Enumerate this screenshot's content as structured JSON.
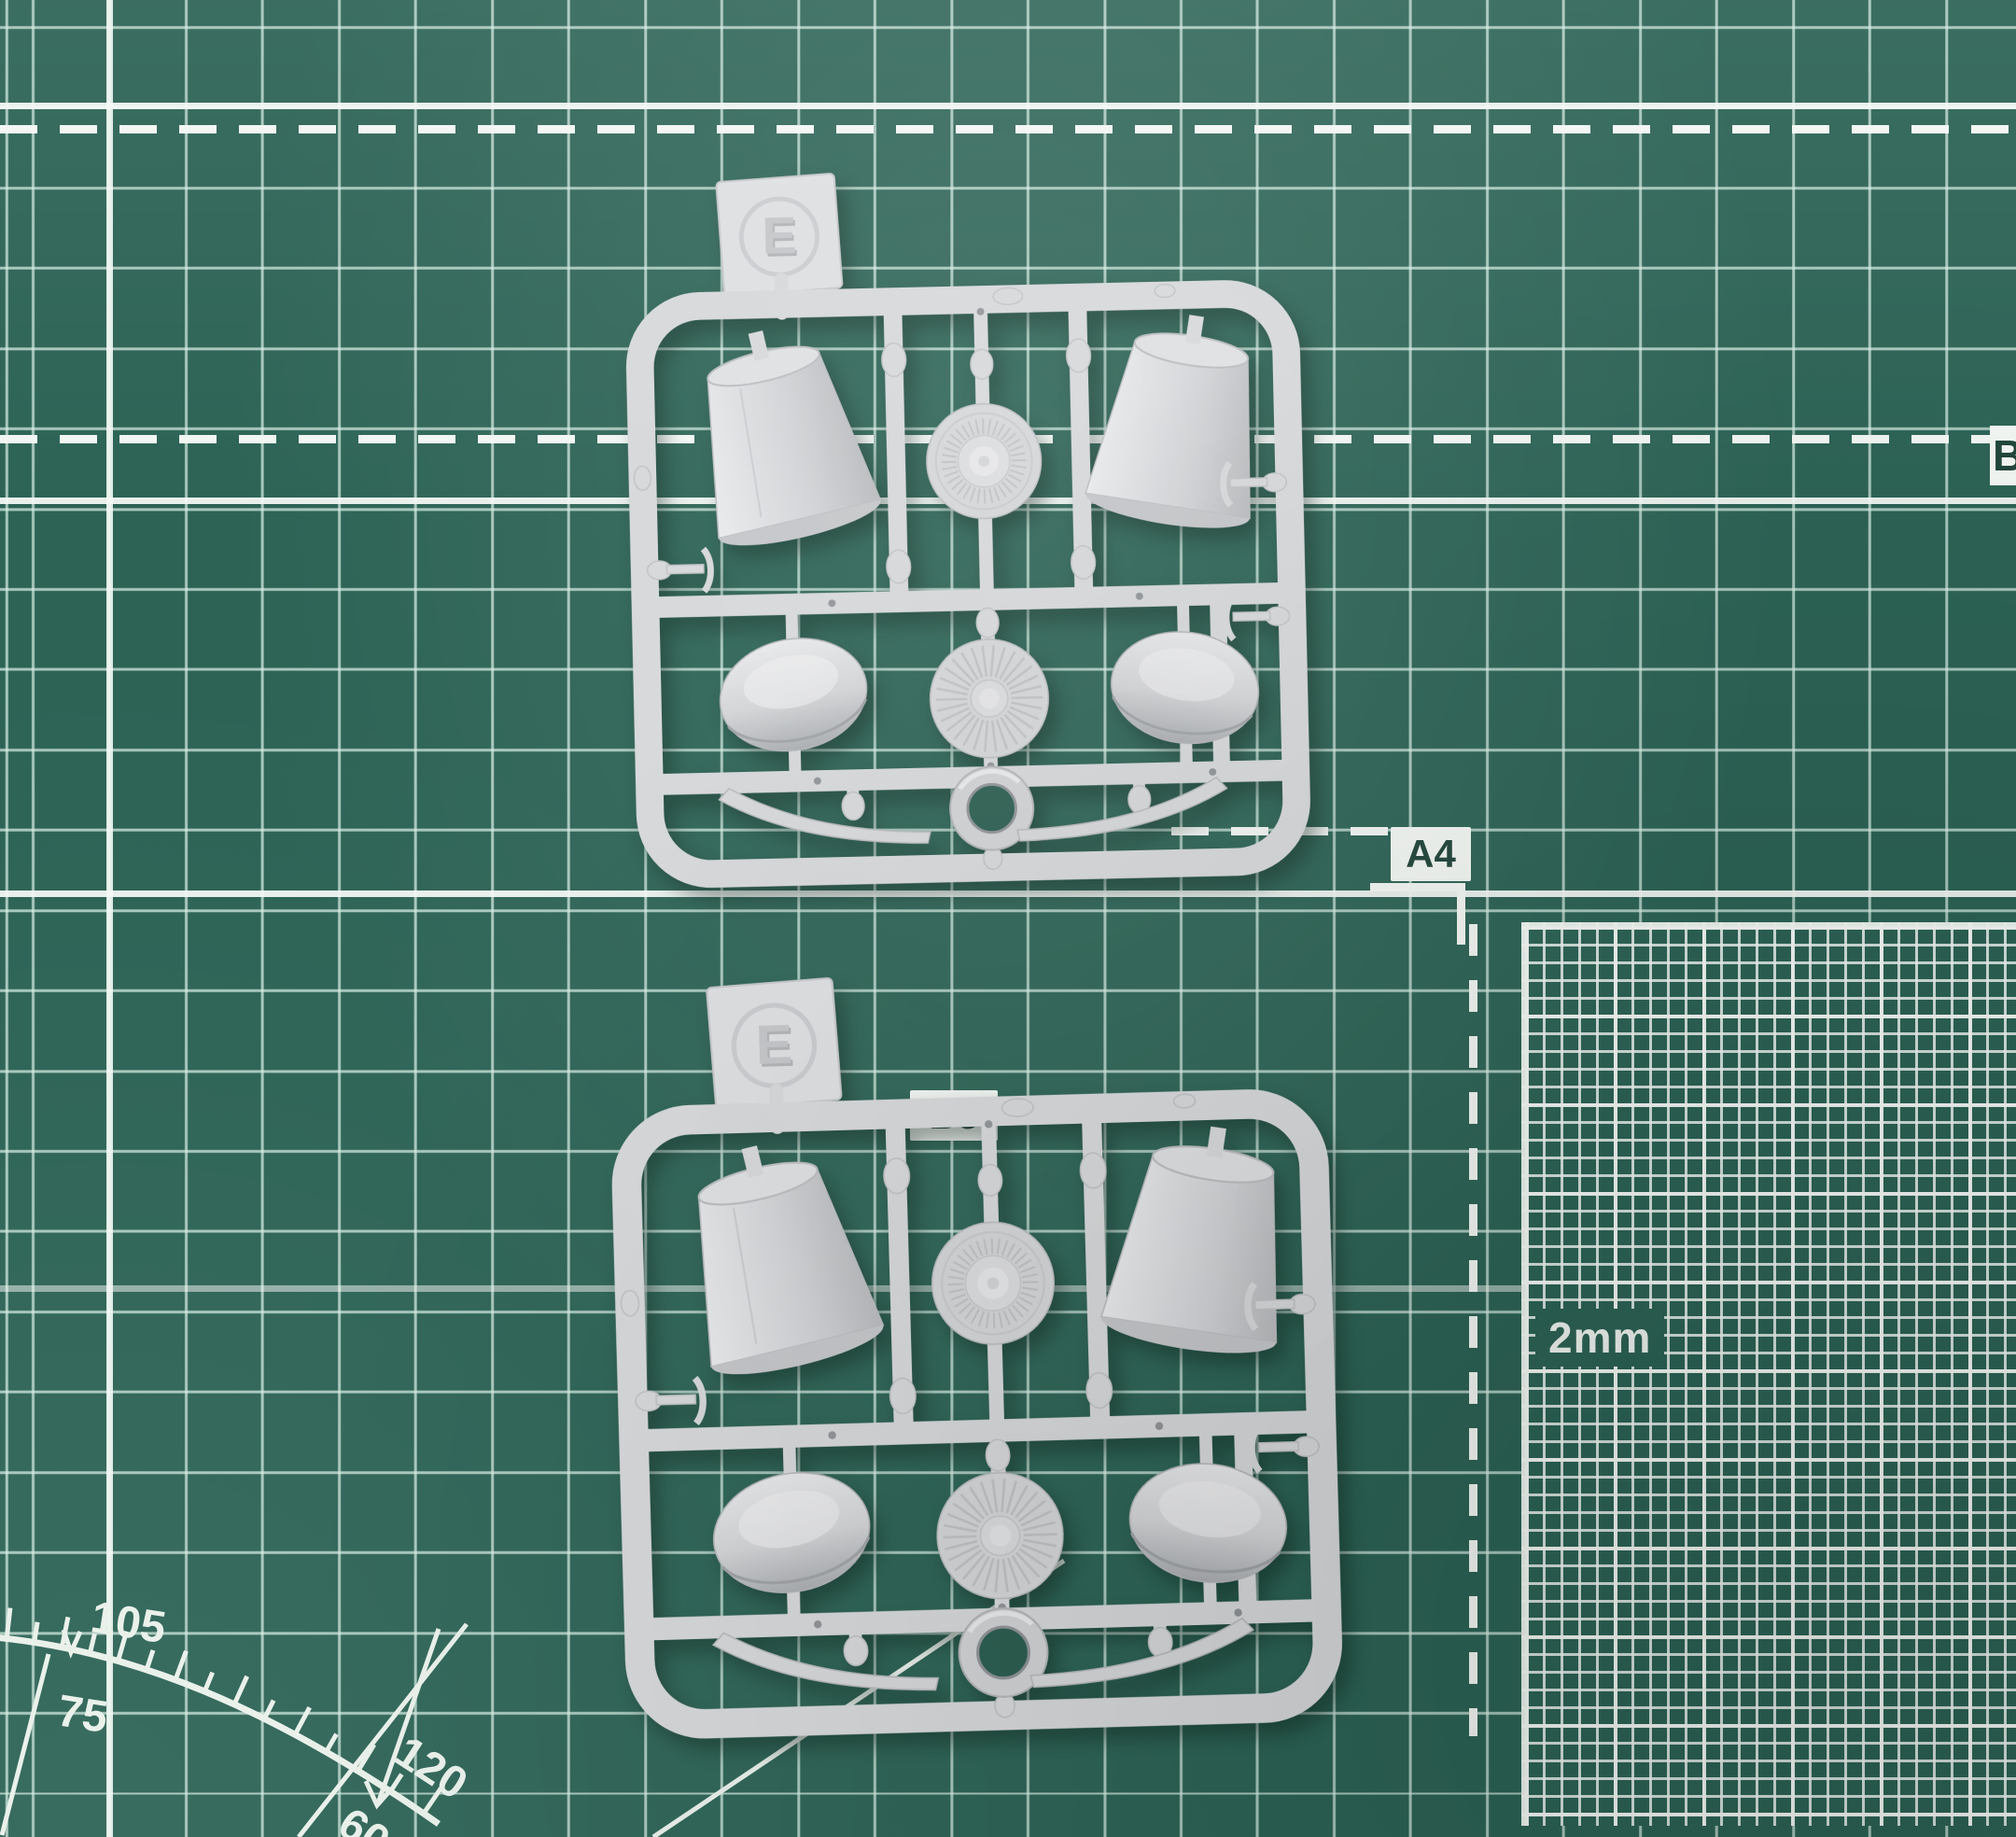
{
  "mat": {
    "colors": {
      "base": "#2c6355",
      "grid_thin": "#d6ece1",
      "grid_bold": "#f3f7f3",
      "label_bg": "#f3f7f3",
      "label_text": "#20453a"
    },
    "labels": {
      "a4": "A4",
      "b5": "B5",
      "fine_grid_scale": "2mm",
      "edge_partial": "B"
    },
    "protractor": {
      "outer_top": "105",
      "inner_top": "75",
      "outer_bottom": "120",
      "inner_bottom": "60"
    }
  },
  "sprues": [
    {
      "tag_letter": "E"
    },
    {
      "tag_letter": "E"
    }
  ],
  "plastic": {
    "color": "#d5d7d9"
  }
}
